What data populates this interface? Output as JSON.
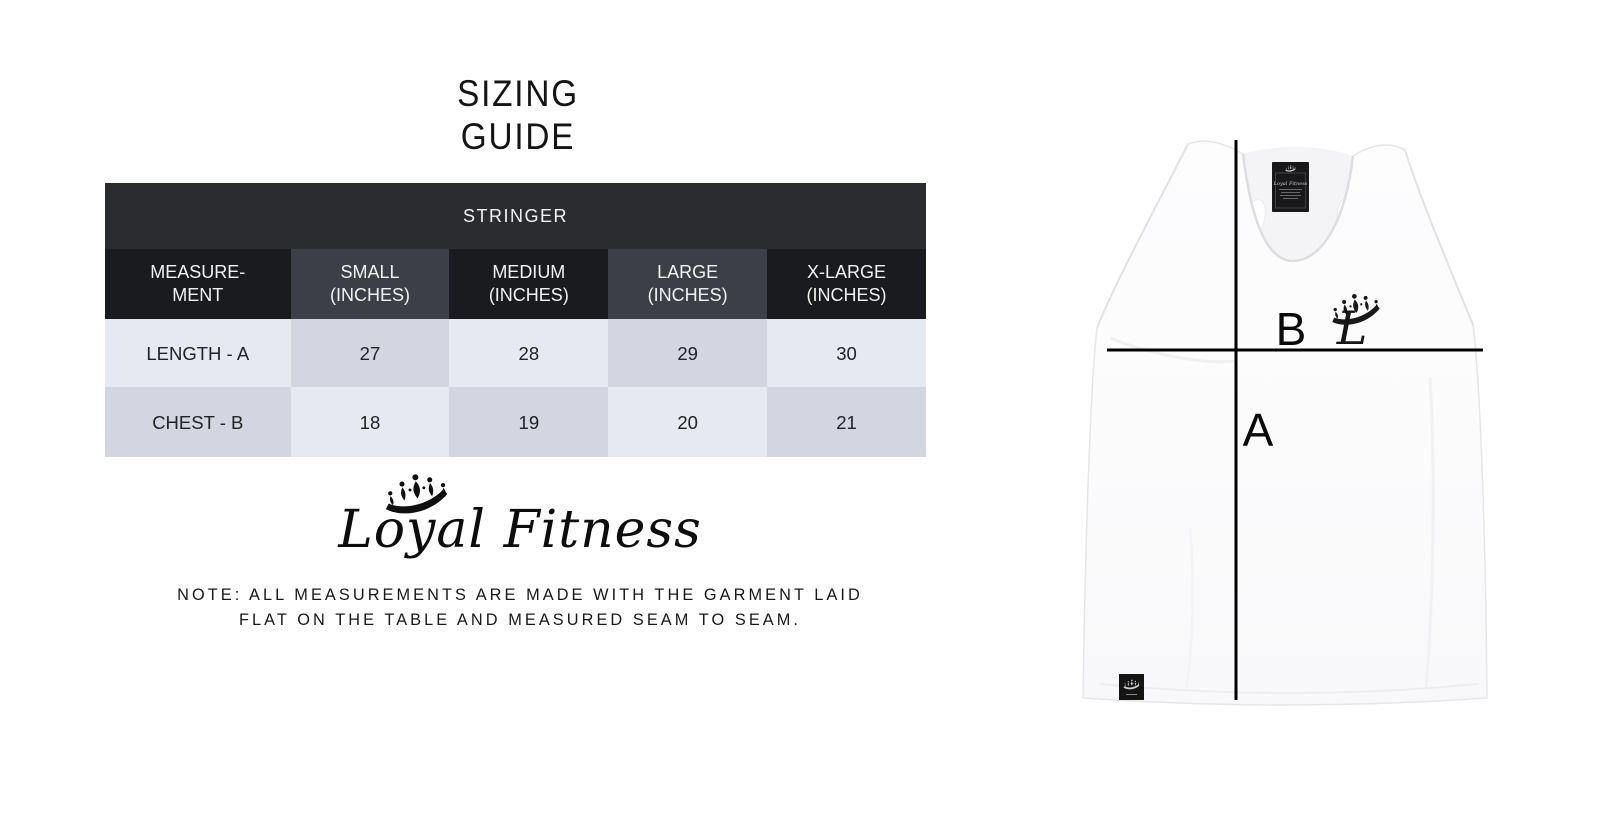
{
  "title": {
    "text": "SIZING\nGUIDE"
  },
  "size_table": {
    "category_header": "STRINGER",
    "columns": [
      "MEASURE-\nMENT",
      "SMALL\n(INCHES)",
      "MEDIUM\n(INCHES)",
      "LARGE\n(INCHES)",
      "X-LARGE\n(INCHES)"
    ],
    "rows": [
      {
        "label": "LENGTH - A",
        "values": [
          "27",
          "28",
          "29",
          "30"
        ]
      },
      {
        "label": "CHEST - B",
        "values": [
          "18",
          "19",
          "20",
          "21"
        ]
      }
    ]
  },
  "brand": {
    "name": "Loyal Fitness",
    "icon": "crown-icon"
  },
  "note": {
    "text": "NOTE: ALL MEASUREMENTS ARE MADE WITH THE GARMENT LAID\nFLAT ON THE TABLE AND MEASURED SEAM TO SEAM."
  },
  "diagram": {
    "garment": "stringer tank top",
    "length_marker": "A",
    "chest_marker": "B",
    "chest_logo_letter": "L",
    "neck_label_text": "Loyal Fitness"
  },
  "colors": {
    "band_bg": "#2b2c30",
    "header_dark": "#1a1b1f",
    "header_mid": "#3c3f46",
    "cell_light": "#e7e9f2",
    "cell_dark": "#d3d5e0",
    "ink": "#141414",
    "measure_line": "#000000",
    "garment_white": "#fcfcfd",
    "label_black": "#18181a"
  },
  "chart_data": {
    "type": "table",
    "title": "SIZING GUIDE",
    "category": "STRINGER",
    "columns": [
      "MEASUREMENT",
      "SMALL (INCHES)",
      "MEDIUM (INCHES)",
      "LARGE (INCHES)",
      "X-LARGE (INCHES)"
    ],
    "rows": [
      [
        "LENGTH - A",
        27,
        28,
        29,
        30
      ],
      [
        "CHEST - B",
        18,
        19,
        20,
        21
      ]
    ]
  }
}
